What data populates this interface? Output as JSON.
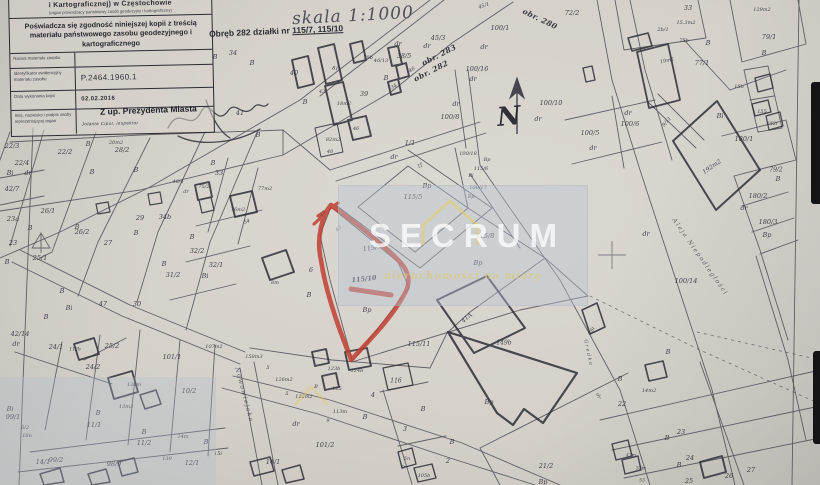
{
  "stamp": {
    "office_line": "i Kartograficznej) w Częstochowie",
    "office_subline": "(organ prowadzący państwowy zasób geodezyjny i kartograficzny)",
    "certification": "Poświadcza się zgodność niniejszej kopii z treścią materiału państwowego zasobu geodezyjnego i kartograficznego",
    "rows": [
      {
        "label": "Nazwa materiału zasobu",
        "value": ""
      },
      {
        "label": "Identyfikator ewidencyjny materiału zasobu",
        "value": "P.2464.1960.1"
      },
      {
        "label": "Data wykonania kopii",
        "value": "02.02.2016"
      },
      {
        "label": "Imię, nazwisko i podpis osoby reprezentującej organ",
        "value": ""
      }
    ],
    "deputy_line": "Z up. Prezydenta Miasta",
    "signature_typed": "Jolanta Cipur, inspektor"
  },
  "titles": {
    "scale": "skala 1:1000",
    "subject_prefix": "Obręb 282 działki nr",
    "subject_parcels": "115/7, 115/10"
  },
  "watermark": {
    "brand": "SECRUM",
    "tagline": "nieruchomości na miarę",
    "box_color": "#b7c5d4",
    "accent": "#e0c964"
  },
  "annotation": {
    "highlighted_parcels": "115/7, 115/10",
    "marker_color": "#c03a2c"
  },
  "map": {
    "labels": [
      {
        "t": "34",
        "x": 233,
        "y": 53
      },
      {
        "t": "B",
        "x": 215,
        "y": 57
      },
      {
        "t": "41",
        "x": 240,
        "y": 113
      },
      {
        "t": "B",
        "x": 258,
        "y": 135
      },
      {
        "t": "B",
        "x": 252,
        "y": 63
      },
      {
        "t": "40",
        "x": 294,
        "y": 73
      },
      {
        "t": "B",
        "x": 305,
        "y": 102
      },
      {
        "t": "81i",
        "x": 336,
        "y": 69,
        "r": 10,
        "s": 5
      },
      {
        "t": "18m2",
        "x": 344,
        "y": 104,
        "s": 5
      },
      {
        "t": "82m2",
        "x": 333,
        "y": 140,
        "s": 5
      },
      {
        "t": "40",
        "x": 330,
        "y": 152,
        "s": 5
      },
      {
        "t": "43",
        "x": 322,
        "y": 92,
        "s": 5
      },
      {
        "t": "46",
        "x": 356,
        "y": 129,
        "s": 5
      },
      {
        "t": "79b",
        "x": 368,
        "y": 58,
        "s": 5
      },
      {
        "t": "B",
        "x": 386,
        "y": 78
      },
      {
        "t": "34",
        "x": 394,
        "y": 87,
        "r": -30,
        "s": 5
      },
      {
        "t": "39",
        "x": 364,
        "y": 94
      },
      {
        "t": "46/13",
        "x": 381,
        "y": 61,
        "s": 5
      },
      {
        "t": "38/5",
        "x": 404,
        "y": 56
      },
      {
        "t": "dr",
        "x": 398,
        "y": 44
      },
      {
        "t": "dr",
        "x": 427,
        "y": 46
      },
      {
        "t": "45/3",
        "x": 438,
        "y": 38
      },
      {
        "t": "obr. 283",
        "x": 439,
        "y": 55,
        "r": -27,
        "c": "obr"
      },
      {
        "t": "obr. 282",
        "x": 431,
        "y": 71,
        "r": -27,
        "c": "obr"
      },
      {
        "t": "46",
        "x": 412,
        "y": 70,
        "r": -30,
        "s": 5
      },
      {
        "t": "obr. 280",
        "x": 540,
        "y": 19,
        "r": 26,
        "c": "obr"
      },
      {
        "t": "45/1",
        "x": 484,
        "y": 6,
        "r": -20,
        "s": 5
      },
      {
        "t": "100/1",
        "x": 500,
        "y": 28
      },
      {
        "t": "dr",
        "x": 484,
        "y": 47
      },
      {
        "t": "72/2",
        "x": 572,
        "y": 13
      },
      {
        "t": "100/16",
        "x": 477,
        "y": 69
      },
      {
        "t": "dr",
        "x": 473,
        "y": 79
      },
      {
        "t": "100/8",
        "x": 450,
        "y": 117
      },
      {
        "t": "dr",
        "x": 456,
        "y": 104
      },
      {
        "t": "100/10",
        "x": 551,
        "y": 103
      },
      {
        "t": "dr",
        "x": 538,
        "y": 119
      },
      {
        "t": "1/1",
        "x": 410,
        "y": 143
      },
      {
        "t": "dr",
        "x": 394,
        "y": 157
      },
      {
        "t": "1f",
        "x": 420,
        "y": 166,
        "r": -30,
        "s": 5
      },
      {
        "t": "33",
        "x": 688,
        "y": 8
      },
      {
        "t": "15.3m2",
        "x": 686,
        "y": 23,
        "s": 5
      },
      {
        "t": "129m2",
        "x": 762,
        "y": 10,
        "s": 5
      },
      {
        "t": "2b/1",
        "x": 663,
        "y": 30,
        "s": 5
      },
      {
        "t": "75b",
        "x": 684,
        "y": 41,
        "s": 5
      },
      {
        "t": "B",
        "x": 708,
        "y": 43
      },
      {
        "t": "19m2",
        "x": 667,
        "y": 61,
        "s": 5,
        "r": -12
      },
      {
        "t": "77/1",
        "x": 702,
        "y": 63
      },
      {
        "t": "79/1",
        "x": 769,
        "y": 37
      },
      {
        "t": "B",
        "x": 764,
        "y": 53
      },
      {
        "t": "15b",
        "x": 739,
        "y": 87,
        "s": 5
      },
      {
        "t": "155",
        "x": 762,
        "y": 112,
        "s": 5
      },
      {
        "t": "Bi",
        "x": 720,
        "y": 116
      },
      {
        "t": "152i",
        "x": 772,
        "y": 124,
        "s": 5
      },
      {
        "t": "180/1",
        "x": 744,
        "y": 139
      },
      {
        "t": "9/11",
        "x": 667,
        "y": 122,
        "r": -50,
        "s": 5
      },
      {
        "t": "dr",
        "x": 628,
        "y": 113
      },
      {
        "t": "100/6",
        "x": 630,
        "y": 124
      },
      {
        "t": "100/5",
        "x": 590,
        "y": 133
      },
      {
        "t": "dr",
        "x": 593,
        "y": 148
      },
      {
        "t": "192m2",
        "x": 712,
        "y": 167,
        "r": -35,
        "s": 6
      },
      {
        "t": "79/2",
        "x": 776,
        "y": 170,
        "s": 6
      },
      {
        "t": "B",
        "x": 778,
        "y": 179
      },
      {
        "t": "180/2",
        "x": 758,
        "y": 196
      },
      {
        "t": "dr",
        "x": 744,
        "y": 208
      },
      {
        "t": "180/3",
        "x": 768,
        "y": 222
      },
      {
        "t": "Bp",
        "x": 767,
        "y": 235
      },
      {
        "t": "100/14",
        "x": 686,
        "y": 281
      },
      {
        "t": "dr",
        "x": 646,
        "y": 234
      },
      {
        "t": "Aleja Niepodległości",
        "x": 700,
        "y": 257,
        "r": 55,
        "s": 6,
        "c": "street"
      },
      {
        "t": "N",
        "x": 509,
        "y": 117,
        "c": "north",
        "r": -5
      },
      {
        "t": "100/18",
        "x": 468,
        "y": 154,
        "s": 5
      },
      {
        "t": "Bp",
        "x": 487,
        "y": 160,
        "s": 5
      },
      {
        "t": "115/6",
        "x": 481,
        "y": 169,
        "s": 5
      },
      {
        "t": "Bi",
        "x": 471,
        "y": 176,
        "s": 5
      },
      {
        "t": "100/17",
        "x": 478,
        "y": 188,
        "s": 5
      },
      {
        "t": "Bp",
        "x": 471,
        "y": 197,
        "s": 5
      },
      {
        "t": "115/5",
        "x": 413,
        "y": 197
      },
      {
        "t": "Bp",
        "x": 427,
        "y": 186
      },
      {
        "t": "115/8",
        "x": 485,
        "y": 236
      },
      {
        "t": "Bp",
        "x": 478,
        "y": 263
      },
      {
        "t": "115/7",
        "x": 372,
        "y": 248,
        "r": -8
      },
      {
        "t": "115/10",
        "x": 364,
        "y": 279,
        "r": -6,
        "w": 1
      },
      {
        "t": "Bp",
        "x": 367,
        "y": 310
      },
      {
        "t": "45",
        "x": 323,
        "y": 214,
        "r": -40,
        "s": 5,
        "c": "faint"
      },
      {
        "t": "43",
        "x": 339,
        "y": 229,
        "r": -40,
        "s": 5,
        "c": "faint"
      },
      {
        "t": "6",
        "x": 311,
        "y": 270
      },
      {
        "t": "B",
        "x": 309,
        "y": 295
      },
      {
        "t": "115/11",
        "x": 419,
        "y": 344
      },
      {
        "t": "41A",
        "x": 467,
        "y": 318,
        "r": -40,
        "s": 6
      },
      {
        "t": "149b",
        "x": 504,
        "y": 343,
        "s": 6
      },
      {
        "t": "22/3",
        "x": 12,
        "y": 146
      },
      {
        "t": "22/2",
        "x": 65,
        "y": 152
      },
      {
        "t": "22/4",
        "x": 22,
        "y": 163
      },
      {
        "t": "dr",
        "x": 28,
        "y": 173
      },
      {
        "t": "Bi",
        "x": 10,
        "y": 173
      },
      {
        "t": "42/7",
        "x": 12,
        "y": 189
      },
      {
        "t": "26/1",
        "x": 48,
        "y": 211
      },
      {
        "t": "23a",
        "x": 13,
        "y": 219
      },
      {
        "t": "B",
        "x": 30,
        "y": 228
      },
      {
        "t": "B",
        "x": 77,
        "y": 227
      },
      {
        "t": "26/2",
        "x": 82,
        "y": 232
      },
      {
        "t": "23",
        "x": 13,
        "y": 243
      },
      {
        "t": "25/1",
        "x": 40,
        "y": 258
      },
      {
        "t": "B",
        "x": 7,
        "y": 262
      },
      {
        "t": "B",
        "x": 62,
        "y": 291
      },
      {
        "t": "20m2",
        "x": 116,
        "y": 143,
        "s": 5
      },
      {
        "t": "B",
        "x": 88,
        "y": 144
      },
      {
        "t": "28/2",
        "x": 122,
        "y": 150
      },
      {
        "t": "B",
        "x": 92,
        "y": 172
      },
      {
        "t": "29",
        "x": 140,
        "y": 218
      },
      {
        "t": "27",
        "x": 108,
        "y": 243
      },
      {
        "t": "34b",
        "x": 165,
        "y": 217
      },
      {
        "t": "B",
        "x": 136,
        "y": 233
      },
      {
        "t": "46/4",
        "x": 178,
        "y": 182,
        "s": 5
      },
      {
        "t": "dr",
        "x": 186,
        "y": 192,
        "s": 5
      },
      {
        "t": "75/2",
        "x": 204,
        "y": 187,
        "s": 5
      },
      {
        "t": "33",
        "x": 219,
        "y": 173
      },
      {
        "t": "B",
        "x": 213,
        "y": 163
      },
      {
        "t": "B",
        "x": 136,
        "y": 170
      },
      {
        "t": "77m2",
        "x": 265,
        "y": 189,
        "s": 5
      },
      {
        "t": "76m2",
        "x": 238,
        "y": 210,
        "s": 5
      },
      {
        "t": "54",
        "x": 247,
        "y": 222,
        "r": -25,
        "s": 5
      },
      {
        "t": "B",
        "x": 192,
        "y": 237
      },
      {
        "t": "32/2",
        "x": 197,
        "y": 251
      },
      {
        "t": "32/1",
        "x": 216,
        "y": 265
      },
      {
        "t": "31/2",
        "x": 173,
        "y": 275
      },
      {
        "t": "B",
        "x": 164,
        "y": 264
      },
      {
        "t": "Bi",
        "x": 205,
        "y": 276
      },
      {
        "t": "8m",
        "x": 275,
        "y": 283,
        "s": 5
      },
      {
        "t": "30",
        "x": 137,
        "y": 304
      },
      {
        "t": "47",
        "x": 103,
        "y": 304
      },
      {
        "t": "Bi",
        "x": 69,
        "y": 308
      },
      {
        "t": "B",
        "x": 46,
        "y": 317
      },
      {
        "t": "42/14",
        "x": 20,
        "y": 334
      },
      {
        "t": "dr",
        "x": 16,
        "y": 344
      },
      {
        "t": "24/1",
        "x": 56,
        "y": 347
      },
      {
        "t": "112b",
        "x": 75,
        "y": 350,
        "s": 4.5
      },
      {
        "t": "24/2",
        "x": 93,
        "y": 367
      },
      {
        "t": "25/2",
        "x": 112,
        "y": 346
      },
      {
        "t": "Bi",
        "x": 10,
        "y": 409
      },
      {
        "t": "99/1",
        "x": 13,
        "y": 417
      },
      {
        "t": "99/2",
        "x": 56,
        "y": 460
      },
      {
        "t": "98/9",
        "x": 114,
        "y": 464
      },
      {
        "t": "14/1",
        "x": 43,
        "y": 462
      },
      {
        "t": "16n",
        "x": 27,
        "y": 436,
        "s": 5
      },
      {
        "t": "6/2",
        "x": 25,
        "y": 428,
        "s": 5
      },
      {
        "t": "101/1",
        "x": 172,
        "y": 357
      },
      {
        "t": "107m2",
        "x": 214,
        "y": 347,
        "s": 5
      },
      {
        "t": "10/2",
        "x": 189,
        "y": 391
      },
      {
        "t": "138m",
        "x": 134,
        "y": 385,
        "s": 5
      },
      {
        "t": "13m3",
        "x": 126,
        "y": 407,
        "s": 5
      },
      {
        "t": "11/1",
        "x": 94,
        "y": 425
      },
      {
        "t": "B",
        "x": 98,
        "y": 413
      },
      {
        "t": "11/2",
        "x": 144,
        "y": 443
      },
      {
        "t": "B",
        "x": 144,
        "y": 432
      },
      {
        "t": "14m",
        "x": 183,
        "y": 437,
        "s": 5
      },
      {
        "t": "B",
        "x": 206,
        "y": 442
      },
      {
        "t": "12/1",
        "x": 192,
        "y": 463
      },
      {
        "t": "15i",
        "x": 218,
        "y": 454,
        "s": 5
      },
      {
        "t": "139",
        "x": 167,
        "y": 459,
        "s": 5
      },
      {
        "t": "Nowowiejska",
        "x": 244,
        "y": 395,
        "r": 75,
        "s": 6,
        "c": "street"
      },
      {
        "t": "158m3",
        "x": 254,
        "y": 357,
        "s": 5
      },
      {
        "t": "126m2",
        "x": 284,
        "y": 380,
        "s": 5
      },
      {
        "t": "5",
        "x": 268,
        "y": 368,
        "s": 5
      },
      {
        "t": "5",
        "x": 287,
        "y": 394,
        "s": 5
      },
      {
        "t": "122m2",
        "x": 304,
        "y": 397,
        "s": 5
      },
      {
        "t": "B",
        "x": 316,
        "y": 387,
        "s": 5
      },
      {
        "t": "125",
        "x": 337,
        "y": 389,
        "s": 5
      },
      {
        "t": "123b",
        "x": 334,
        "y": 369,
        "s": 5
      },
      {
        "t": "124b",
        "x": 357,
        "y": 371,
        "s": 5
      },
      {
        "t": "113m",
        "x": 340,
        "y": 412,
        "s": 5
      },
      {
        "t": "9",
        "x": 328,
        "y": 421,
        "s": 5
      },
      {
        "t": "B",
        "x": 365,
        "y": 417
      },
      {
        "t": "4",
        "x": 373,
        "y": 395
      },
      {
        "t": "101/2",
        "x": 325,
        "y": 445
      },
      {
        "t": "dr",
        "x": 296,
        "y": 424
      },
      {
        "t": "14/1",
        "x": 273,
        "y": 462
      },
      {
        "t": "116",
        "x": 396,
        "y": 381,
        "s": 6
      },
      {
        "t": "B",
        "x": 423,
        "y": 409
      },
      {
        "t": "3",
        "x": 405,
        "y": 429
      },
      {
        "t": "B",
        "x": 452,
        "y": 442
      },
      {
        "t": "2",
        "x": 448,
        "y": 461
      },
      {
        "t": "5n",
        "x": 407,
        "y": 459,
        "s": 5
      },
      {
        "t": "7r",
        "x": 403,
        "y": 468,
        "s": 4.5
      },
      {
        "t": "105b",
        "x": 424,
        "y": 476,
        "s": 5
      },
      {
        "t": "21/2",
        "x": 546,
        "y": 466
      },
      {
        "t": "Bp",
        "x": 543,
        "y": 482
      },
      {
        "t": "Bp",
        "x": 489,
        "y": 402
      },
      {
        "t": "26i",
        "x": 592,
        "y": 331,
        "r": -60,
        "s": 5
      },
      {
        "t": "Gredka",
        "x": 588,
        "y": 353,
        "r": 78,
        "s": 5,
        "c": "street"
      },
      {
        "t": "B",
        "x": 620,
        "y": 379
      },
      {
        "t": "14m2",
        "x": 649,
        "y": 391,
        "s": 5
      },
      {
        "t": "dr",
        "x": 598,
        "y": 396,
        "r": 70,
        "s": 5
      },
      {
        "t": "22",
        "x": 622,
        "y": 404
      },
      {
        "t": "B",
        "x": 668,
        "y": 352
      },
      {
        "t": "23",
        "x": 681,
        "y": 432
      },
      {
        "t": "B",
        "x": 667,
        "y": 438
      },
      {
        "t": "24",
        "x": 690,
        "y": 458
      },
      {
        "t": "B",
        "x": 679,
        "y": 465
      },
      {
        "t": "25",
        "x": 689,
        "y": 481
      },
      {
        "t": "26",
        "x": 729,
        "y": 476
      },
      {
        "t": "27",
        "x": 751,
        "y": 470
      },
      {
        "t": "47m",
        "x": 631,
        "y": 456,
        "s": 4.5
      },
      {
        "t": "52m",
        "x": 641,
        "y": 469,
        "s": 4.5
      },
      {
        "t": "53",
        "x": 642,
        "y": 481,
        "s": 4.5
      }
    ]
  }
}
